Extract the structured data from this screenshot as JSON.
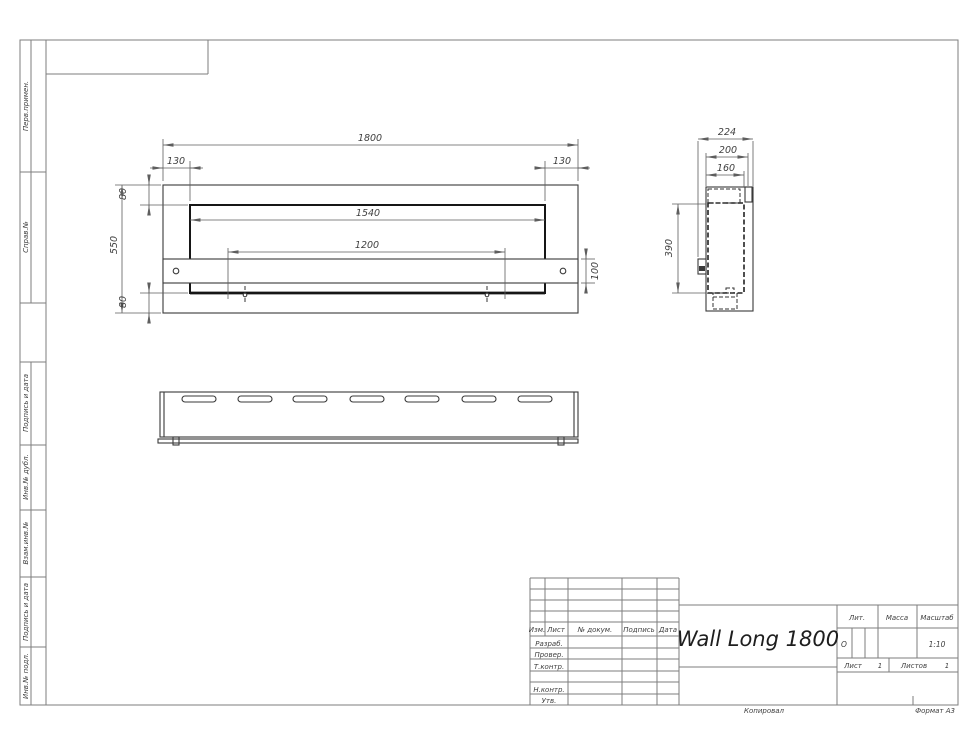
{
  "sheet": {
    "sidebar": {
      "labels": [
        "Перв.примен.",
        "Справ.№",
        "Подпись и дата",
        "Инв.№ дубл.",
        "Взам.инв.№",
        "Подпись и дата",
        "Инв.№ подл."
      ]
    },
    "footer": {
      "copied": "Копировал",
      "format": "Формат А3"
    }
  },
  "title_block": {
    "doc_title": "Wall Long 1800",
    "cols": {
      "izm": "Изм.",
      "list": "Лист",
      "doc": "№ докум.",
      "sign": "Подпись",
      "date": "Дата"
    },
    "rows": {
      "razrab": "Разраб.",
      "prover": "Провер.",
      "tkontr": "Т.контр.",
      "nkontr": "Н.контр.",
      "utv": "Утв."
    },
    "lit": {
      "label": "Лит.",
      "value": "О"
    },
    "massa": {
      "label": "Масса",
      "value": ""
    },
    "scale": {
      "label": "Масштаб",
      "value": "1:10"
    },
    "sheet_no": {
      "label": "Лист",
      "value": "1"
    },
    "sheets_total": {
      "label": "Листов",
      "value": "1"
    }
  },
  "dimensions": {
    "front": {
      "overall_width": "1800",
      "offset_left": "130",
      "offset_right": "130",
      "top_flange": "80",
      "overall_height": "550",
      "bottom_flange": "80",
      "opening_width": "1540",
      "mount_spacing": "1200",
      "bracket_height": "100"
    },
    "side": {
      "overall_depth": "224",
      "body_depth": "200",
      "inner_depth": "160",
      "inner_height": "390"
    }
  }
}
